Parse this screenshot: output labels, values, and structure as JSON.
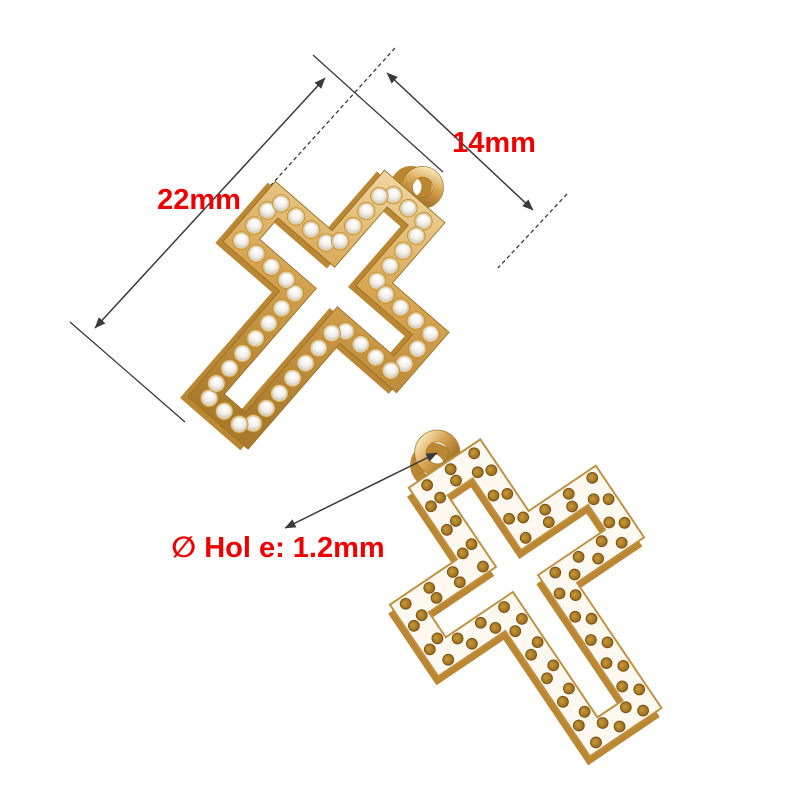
{
  "annotations": {
    "length_label": "22mm",
    "width_label": "14mm",
    "hole_label": "∅ Hol e: 1.2mm"
  },
  "colors": {
    "background": "#ffffff",
    "dimension_line": "#3a3a3a",
    "dimension_text": "#f20000",
    "gold": "#d7a552",
    "gold_light": "#f6e3b2",
    "gold_deep": "#aa7a2c",
    "gold_shadow": "#bb8733",
    "stone_white": "#f2efe9",
    "back_face": "#fdf9f0",
    "hole_amber": "#8f5f12"
  }
}
